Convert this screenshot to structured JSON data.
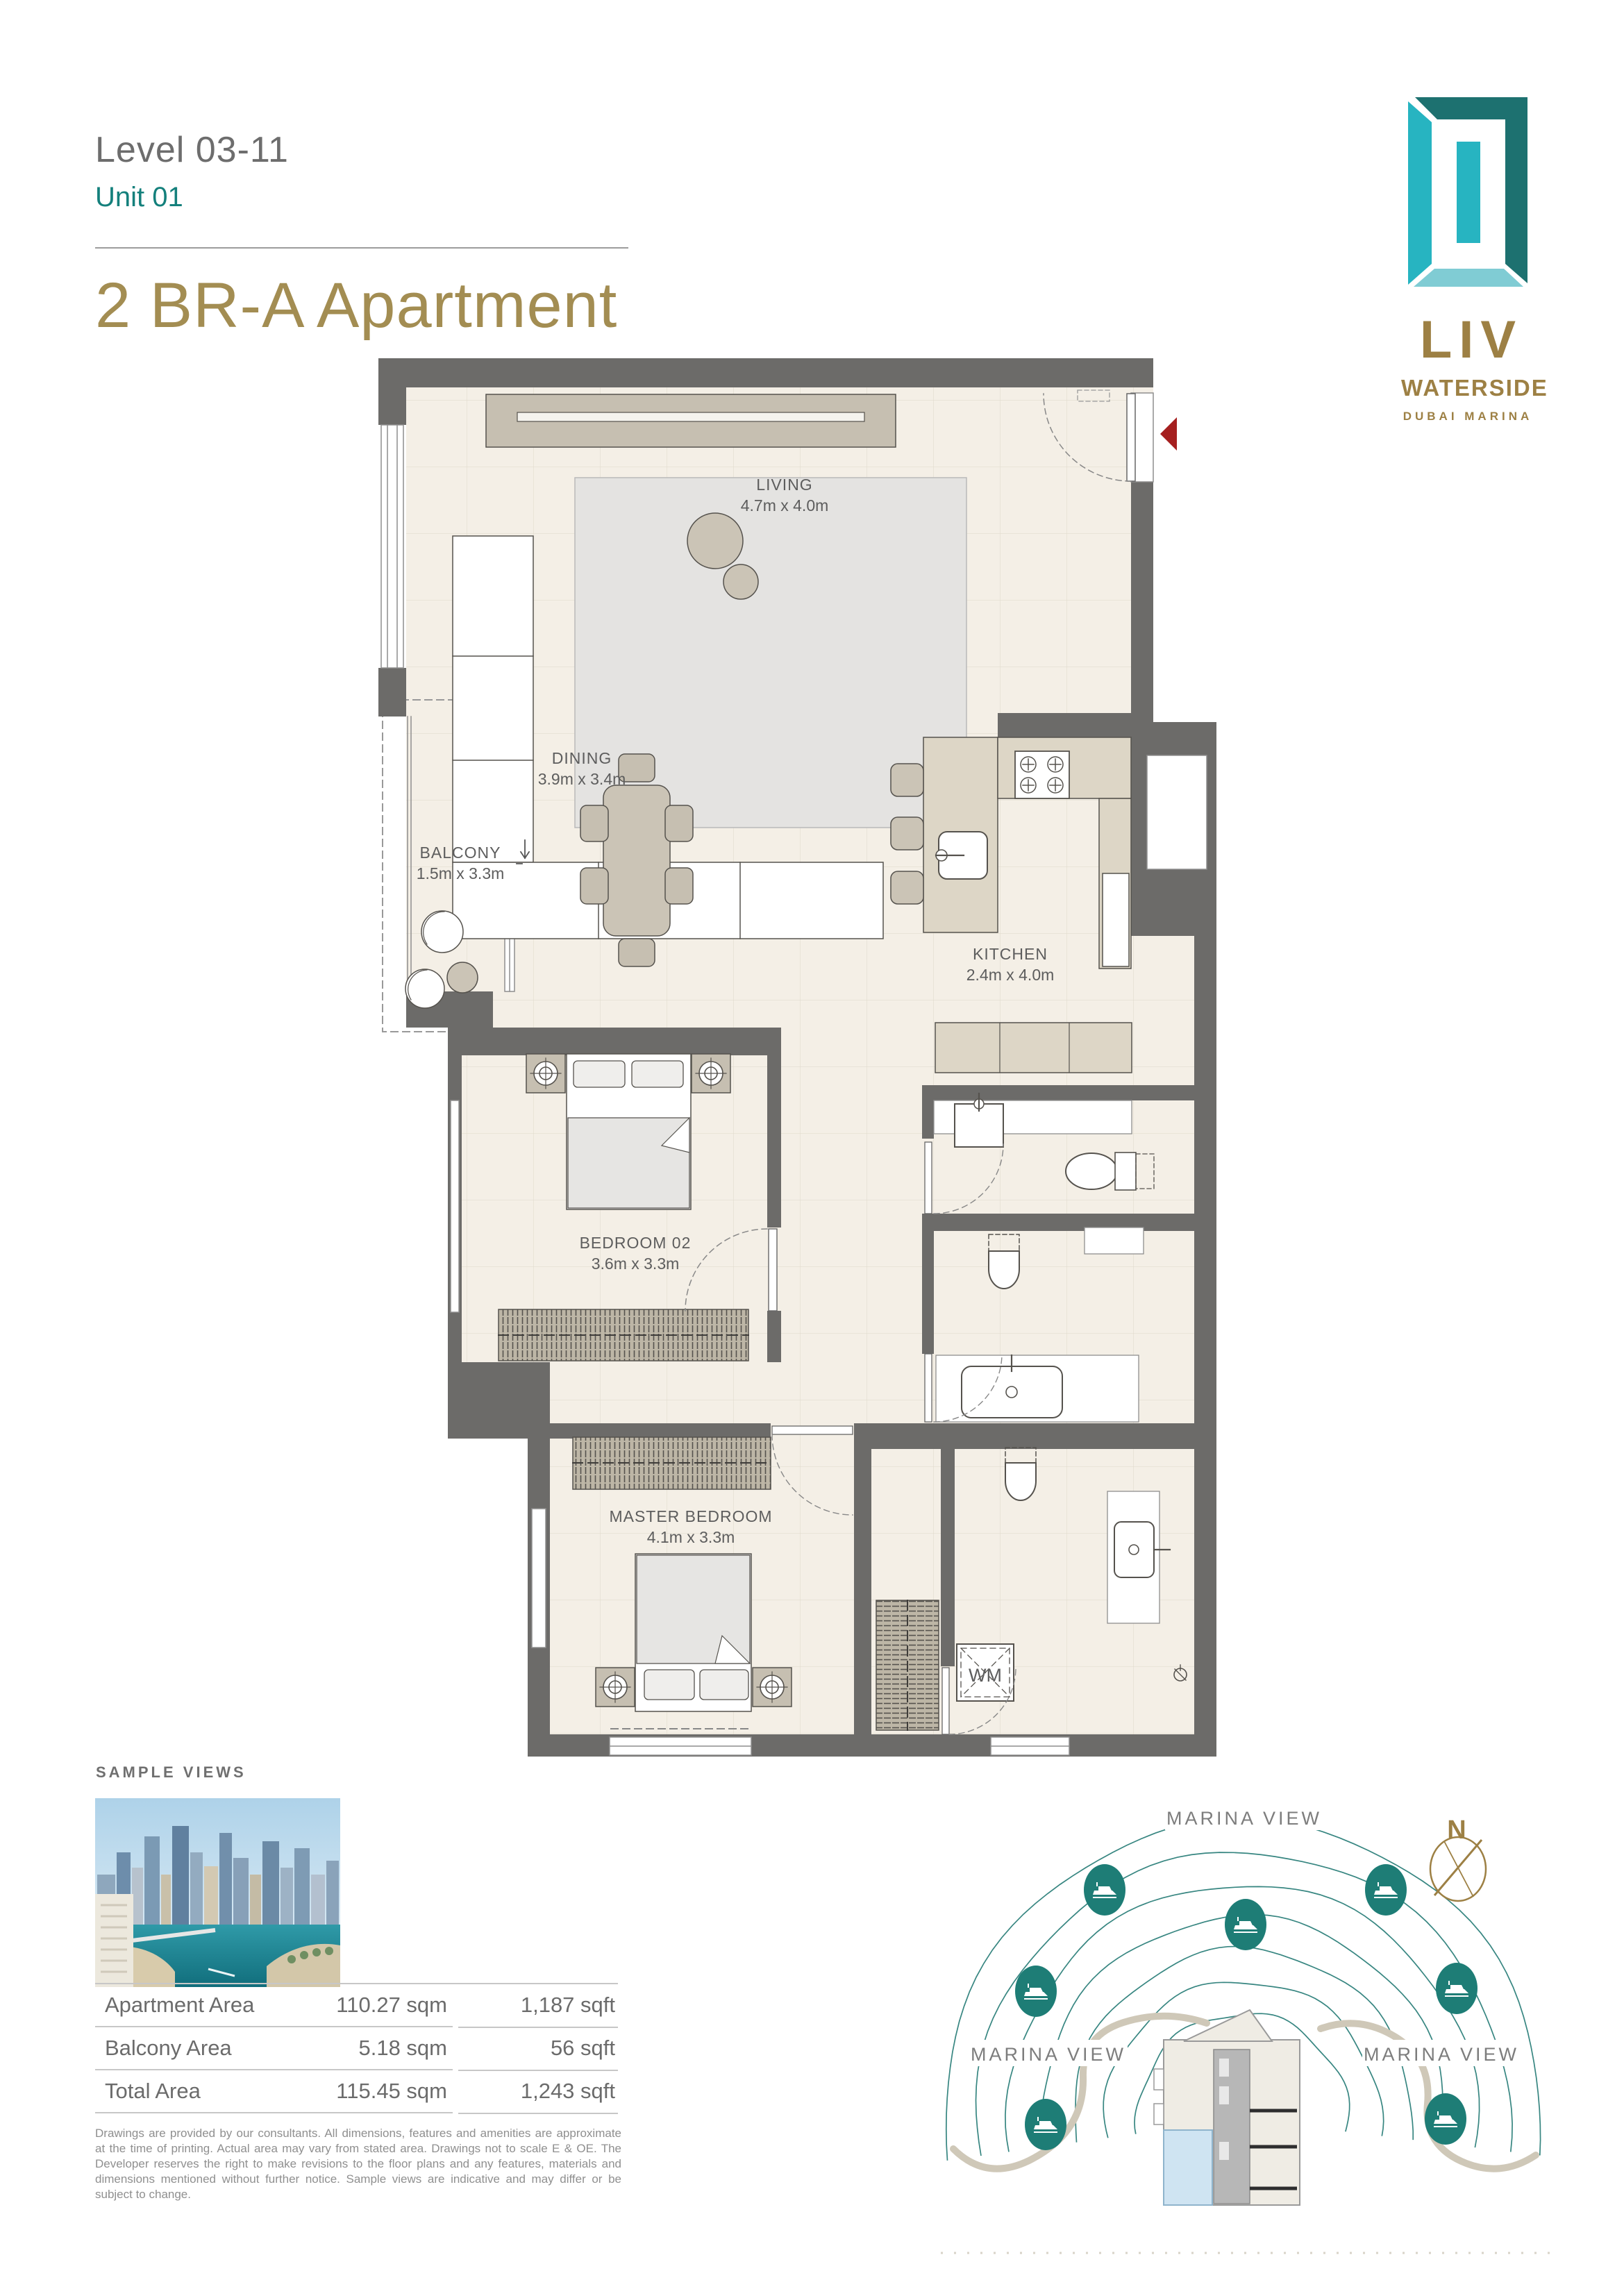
{
  "header": {
    "level": "Level 03-11",
    "unit": "Unit 01",
    "title": "2 BR-A Apartment"
  },
  "logo": {
    "brand": "LIV",
    "sub": "WATERSIDE",
    "location": "DUBAI MARINA"
  },
  "floorplan": {
    "rooms": [
      {
        "name": "LIVING",
        "dims": "4.7m x 4.0m"
      },
      {
        "name": "DINING",
        "dims": "3.9m x 3.4m"
      },
      {
        "name": "BALCONY",
        "dims": "1.5m x 3.3m"
      },
      {
        "name": "KITCHEN",
        "dims": "2.4m x 4.0m"
      },
      {
        "name": "BEDROOM 02",
        "dims": "3.6m x 3.3m"
      },
      {
        "name": "MASTER BEDROOM",
        "dims": "4.1m x 3.3m"
      }
    ],
    "labels": {
      "washing_machine": "WM"
    }
  },
  "sample_views": {
    "heading": "SAMPLE VIEWS"
  },
  "area_table": {
    "rows": [
      {
        "label": "Apartment Area",
        "sqm": "110.27 sqm",
        "sqft": "1,187 sqft"
      },
      {
        "label": "Balcony Area",
        "sqm": "5.18 sqm",
        "sqft": "56 sqft"
      },
      {
        "label": "Total Area",
        "sqm": "115.45 sqm",
        "sqft": "1,243 sqft"
      }
    ]
  },
  "disclaimer": "Drawings are provided by our consultants. All dimensions, features and amenities are approximate at the time of printing. Actual area may vary from stated area.  Drawings not to scale E & OE.  The Developer reserves the right to make revisions to the floor plans and any features, materials and dimensions mentioned without further notice.  Sample views are indicative and may differ or be subject to change.",
  "marina": {
    "labels": [
      "MARINA VIEW",
      "MARINA VIEW",
      "MARINA VIEW"
    ],
    "compass_n": "N"
  },
  "colors": {
    "accent_teal": "#14807c",
    "brand_gold": "#9d8044",
    "wall_gray": "#6c6b69",
    "boat_teal": "#1e7d76",
    "entry_arrow_red": "#a51f1f"
  }
}
